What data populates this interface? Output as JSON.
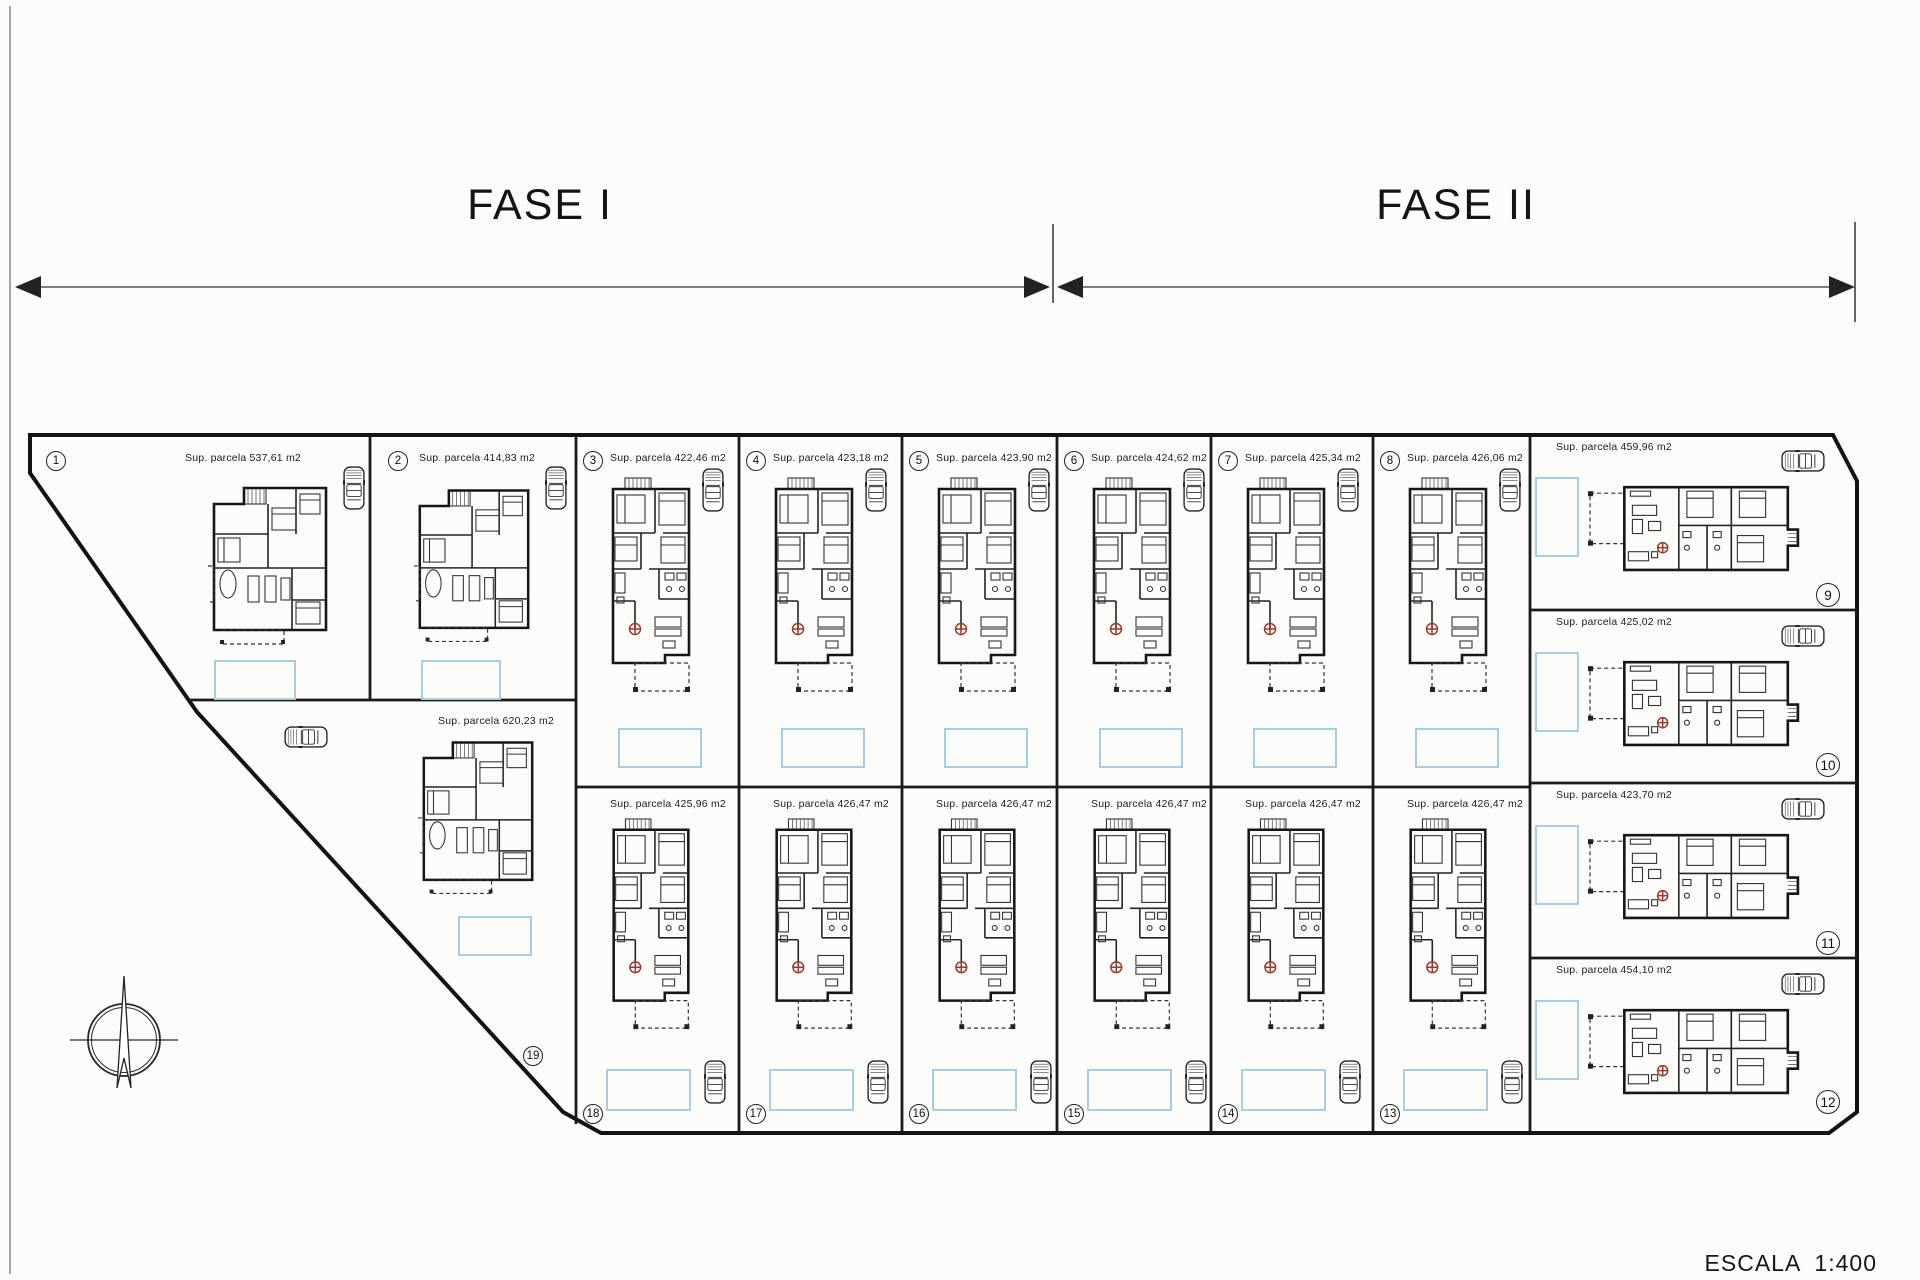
{
  "scale_label": "ESCALA 1:400",
  "phases": [
    {
      "label": "FASE I"
    },
    {
      "label": "FASE II"
    }
  ],
  "area_prefix": "Sup. parcela",
  "area_unit": "m2",
  "parcels": [
    {
      "number": "1",
      "area_m2": "537,61"
    },
    {
      "number": "2",
      "area_m2": "414,83"
    },
    {
      "number": "3",
      "area_m2": "422,46"
    },
    {
      "number": "4",
      "area_m2": "423,18"
    },
    {
      "number": "5",
      "area_m2": "423,90"
    },
    {
      "number": "6",
      "area_m2": "424,62"
    },
    {
      "number": "7",
      "area_m2": "425,34"
    },
    {
      "number": "8",
      "area_m2": "426,06"
    },
    {
      "number": "9",
      "area_m2": "459,96"
    },
    {
      "number": "10",
      "area_m2": "425,02"
    },
    {
      "number": "11",
      "area_m2": "423,70"
    },
    {
      "number": "12",
      "area_m2": "454,10"
    },
    {
      "number": "13",
      "area_m2": "426,47"
    },
    {
      "number": "14",
      "area_m2": "426,47"
    },
    {
      "number": "15",
      "area_m2": "426,47"
    },
    {
      "number": "16",
      "area_m2": "426,47"
    },
    {
      "number": "17",
      "area_m2": "426,47"
    },
    {
      "number": "18",
      "area_m2": "425,96"
    },
    {
      "number": "19",
      "area_m2": "620,23"
    }
  ],
  "colors": {
    "ink": "#1a1a1a",
    "pool_outline": "#a6cede",
    "table_red": "#9a3a2c"
  }
}
